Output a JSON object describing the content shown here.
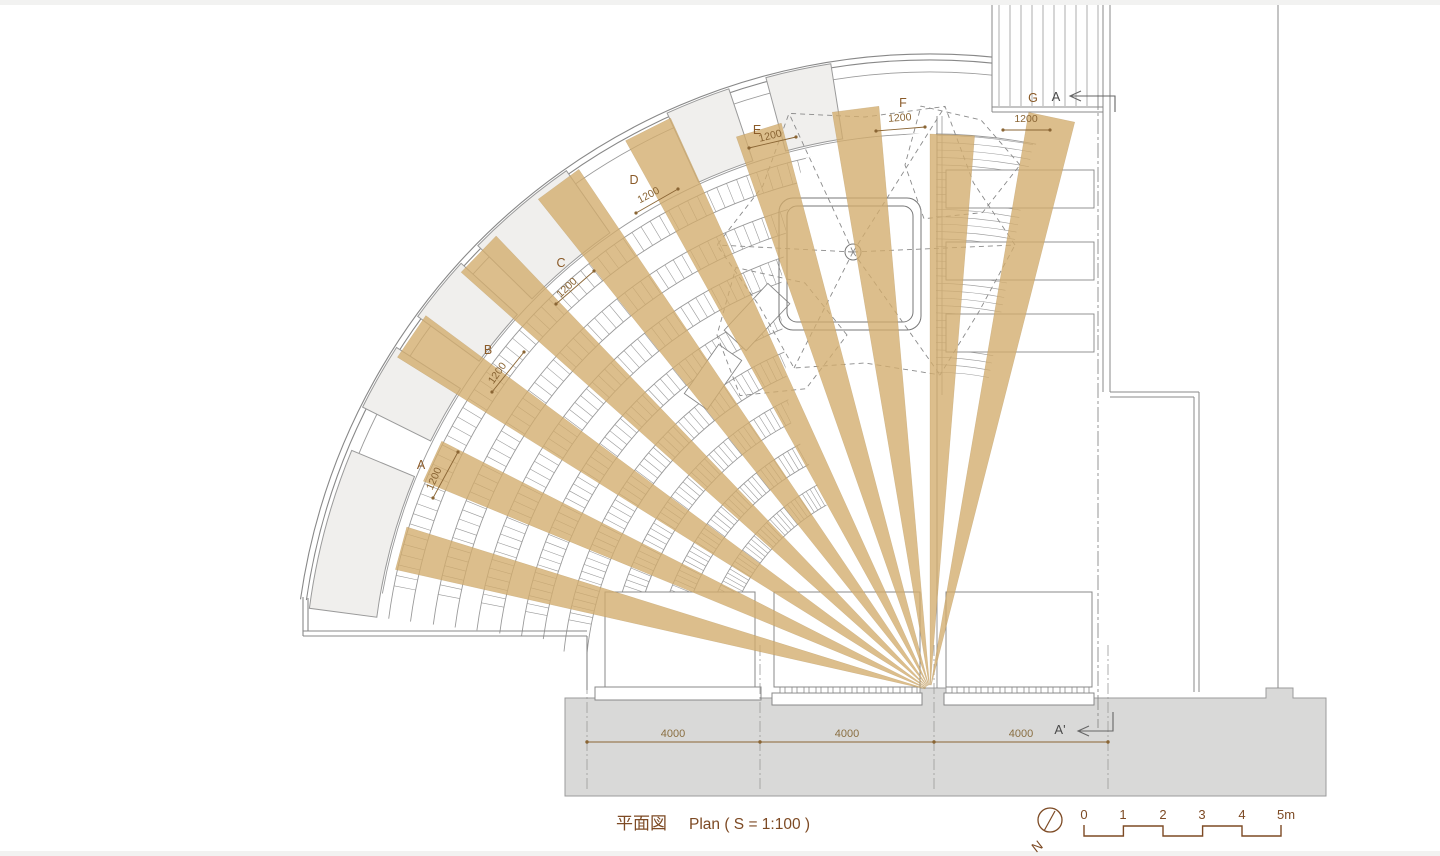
{
  "title": {
    "jp": "平面図",
    "en": "Plan ( S = 1:100 )"
  },
  "landings": {
    "A": "A",
    "B": "B",
    "C": "C",
    "D": "D",
    "E": "E",
    "F": "F",
    "G": "G"
  },
  "dims": {
    "d1200": "1200",
    "d4000": "4000"
  },
  "section": {
    "top": "A",
    "bottom": "A'"
  },
  "scalebar": {
    "t0": "0",
    "t1": "1",
    "t2": "2",
    "t3": "3",
    "t4": "4",
    "t5": "5m"
  },
  "north": {
    "label": "N"
  },
  "colors": {
    "beam": "#d2ac6c",
    "line": "#9a9a9a",
    "hatch": "#9a9a9a",
    "wall": "#888888",
    "band": "#d9d9d8",
    "panel": "#f0efed",
    "planter": "#777777",
    "dash": "#8a8a8a",
    "brown": "#7d4a24",
    "dim": "#8a6534",
    "dark": "#4a4a4a"
  },
  "plan": {
    "beam_angles_deg": [
      165,
      155.3,
      145.7,
      136,
      126.3,
      116.7,
      107,
      97.3,
      87.7,
      78
    ],
    "beam_width_mm": 1200,
    "bay_width_mm": 4000,
    "scale": "1:100"
  }
}
